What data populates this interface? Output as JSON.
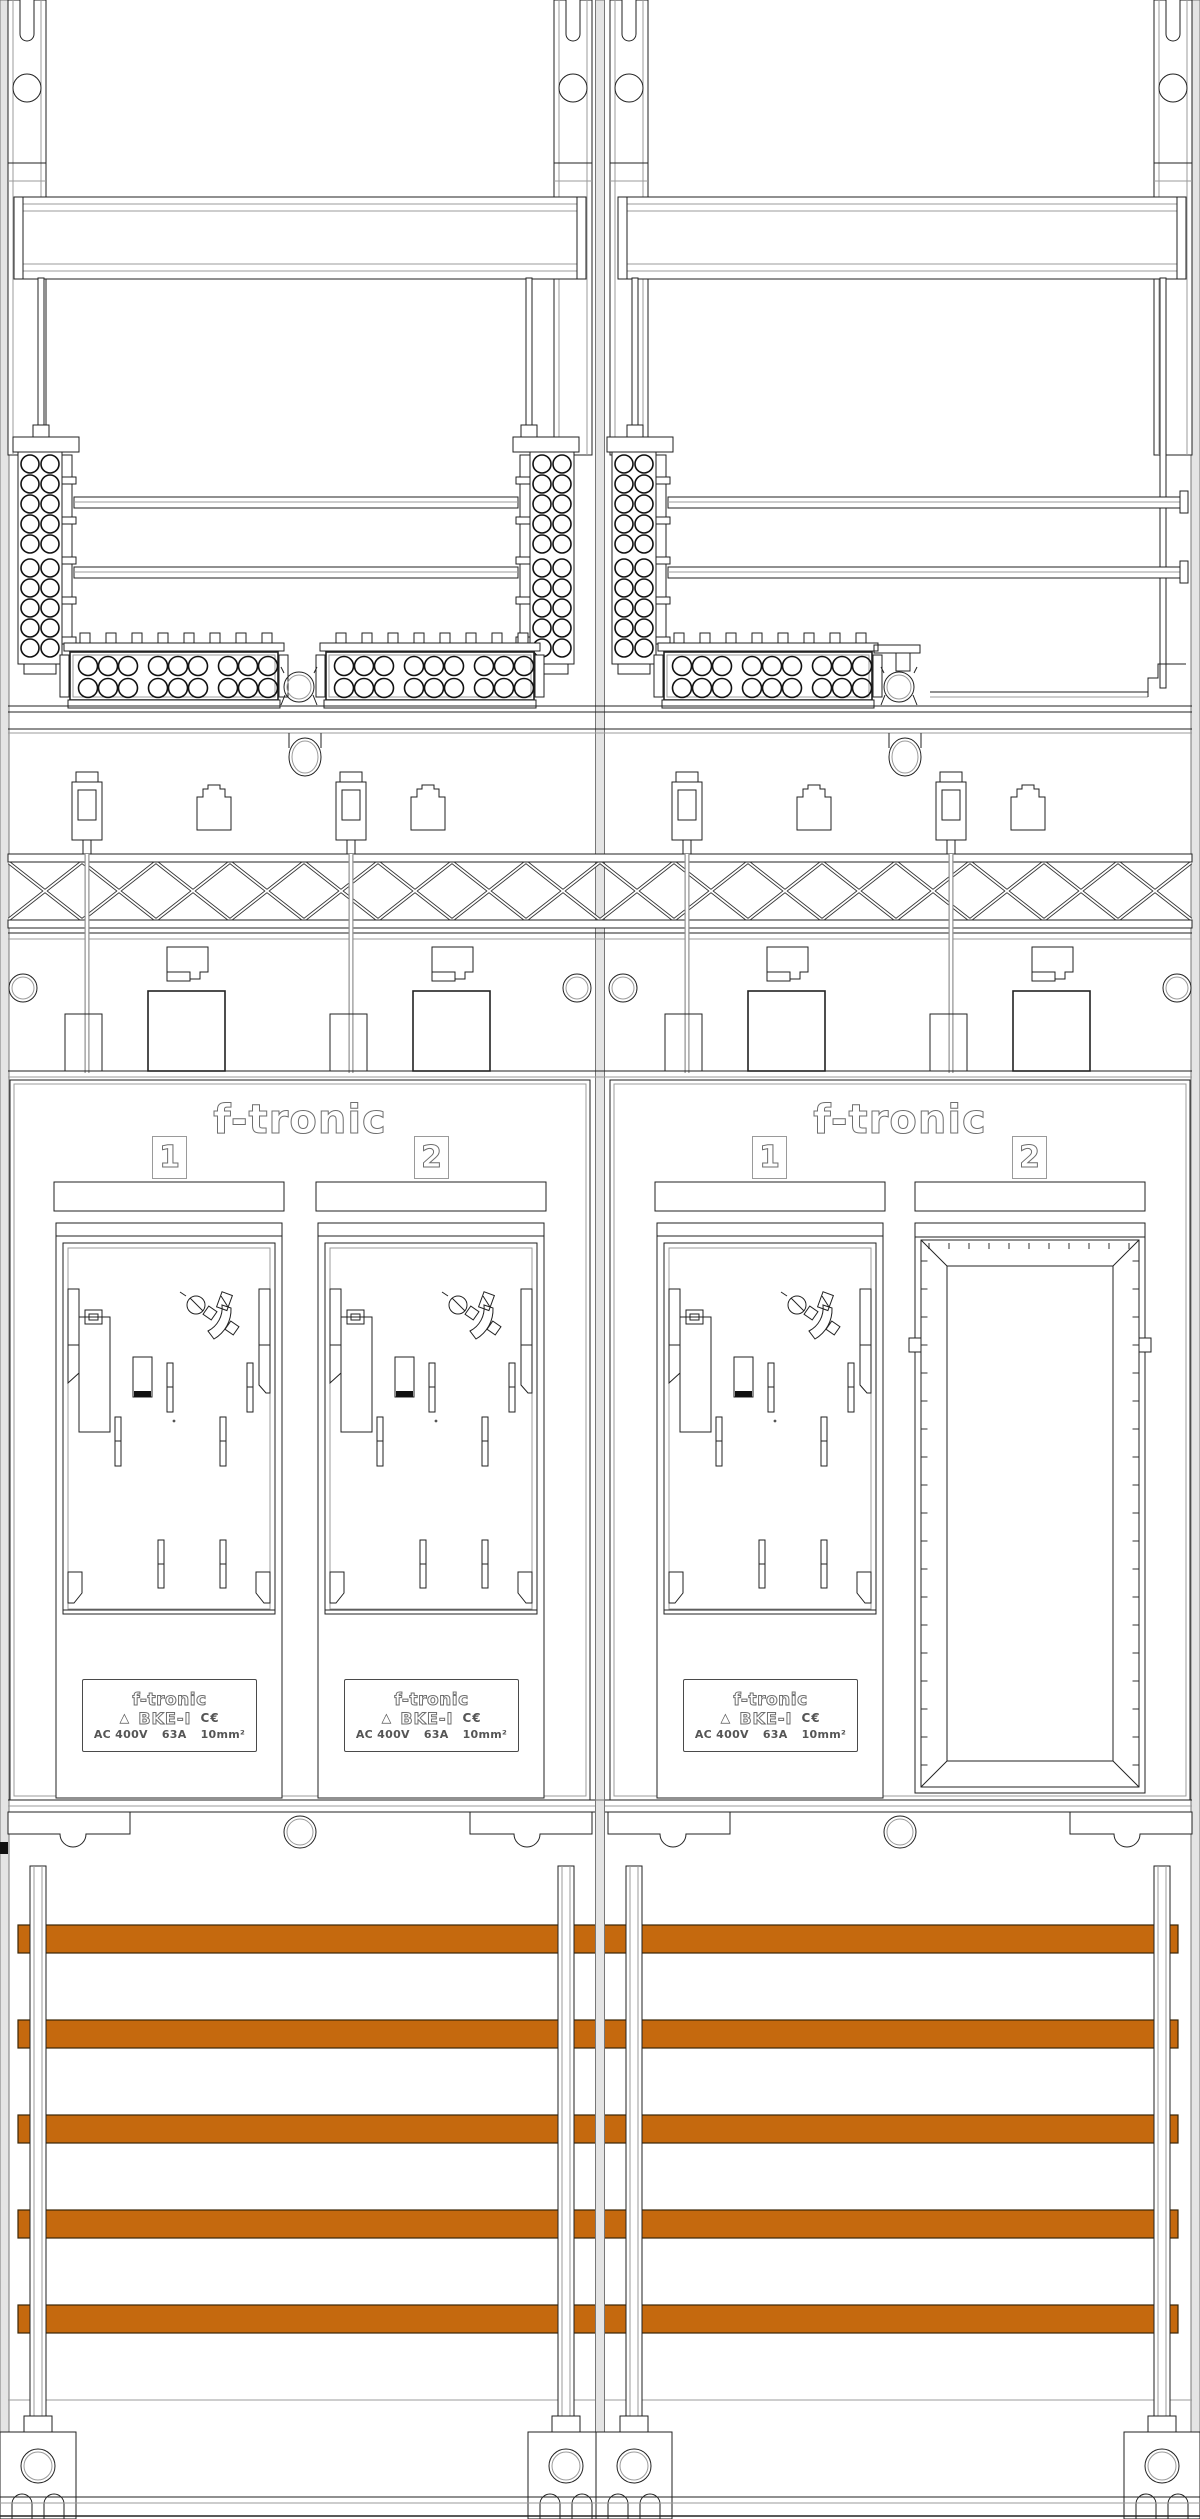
{
  "drawing": {
    "type": "electrical-cabinet-front-view",
    "brand": "f-tronic",
    "sections": [
      {
        "side": "left",
        "slots": [
          {
            "number": "1",
            "occupied": true
          },
          {
            "number": "2",
            "occupied": true
          }
        ]
      },
      {
        "side": "right",
        "slots": [
          {
            "number": "1",
            "occupied": true
          },
          {
            "number": "2",
            "occupied": false
          }
        ]
      }
    ],
    "meter_label": {
      "brand": "f-tronic",
      "model": "BKE-I",
      "ce_mark": "C€",
      "vde_mark": "△",
      "voltage": "AC 400V",
      "current": "63A",
      "cross_section": "10mm²"
    },
    "busbars": {
      "count": 5
    },
    "colors": {
      "busbar": "#C5690E",
      "busbar_edge": "#3A2606",
      "line": "#222222",
      "line_light": "#9B9B9B",
      "rail_gray": "#E4E4E4"
    }
  }
}
